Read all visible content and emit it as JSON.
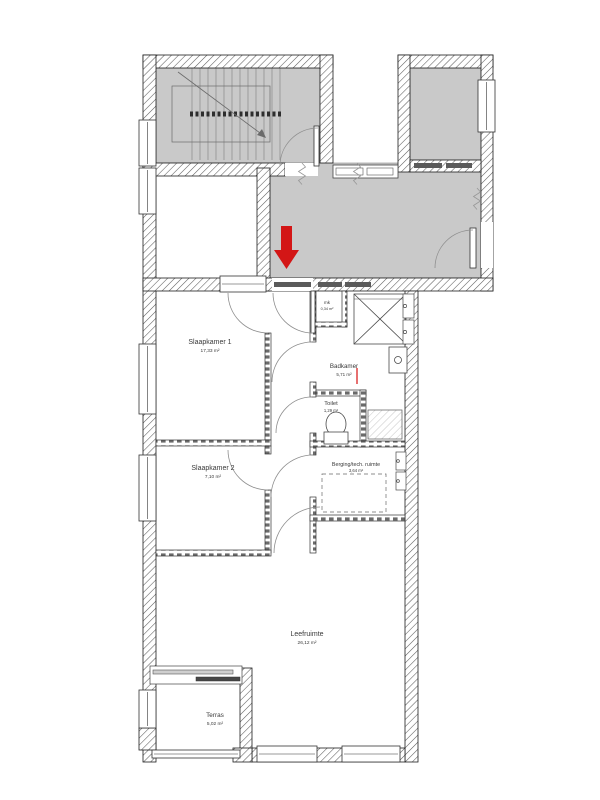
{
  "plan": {
    "kind": "apartment-floorplan",
    "language": "nl"
  },
  "rooms": [
    {
      "id": "slaapkamer-1",
      "name": "Slaapkamer 1",
      "area": "17,33 m²"
    },
    {
      "id": "slaapkamer-2",
      "name": "Slaapkamer 2",
      "area": "7,10 m²"
    },
    {
      "id": "badkamer",
      "name": "Badkamer",
      "area": "5,71 m²"
    },
    {
      "id": "toilet",
      "name": "Toilet",
      "area": "1,29 m²"
    },
    {
      "id": "mk",
      "name": "mk",
      "area": "0,34 m²"
    },
    {
      "id": "berging",
      "name": "Berging/tech. ruimte",
      "area": "3,64 m²"
    },
    {
      "id": "leefruimte",
      "name": "Leefruimte",
      "area": "26,12 m²"
    },
    {
      "id": "terras",
      "name": "Terras",
      "area": "5,02 m²"
    }
  ],
  "colors": {
    "common_area": "#c9c9c9",
    "entrance_arrow": "#d31616",
    "wall_outline": "#1c1c1c",
    "background": "#ffffff"
  }
}
